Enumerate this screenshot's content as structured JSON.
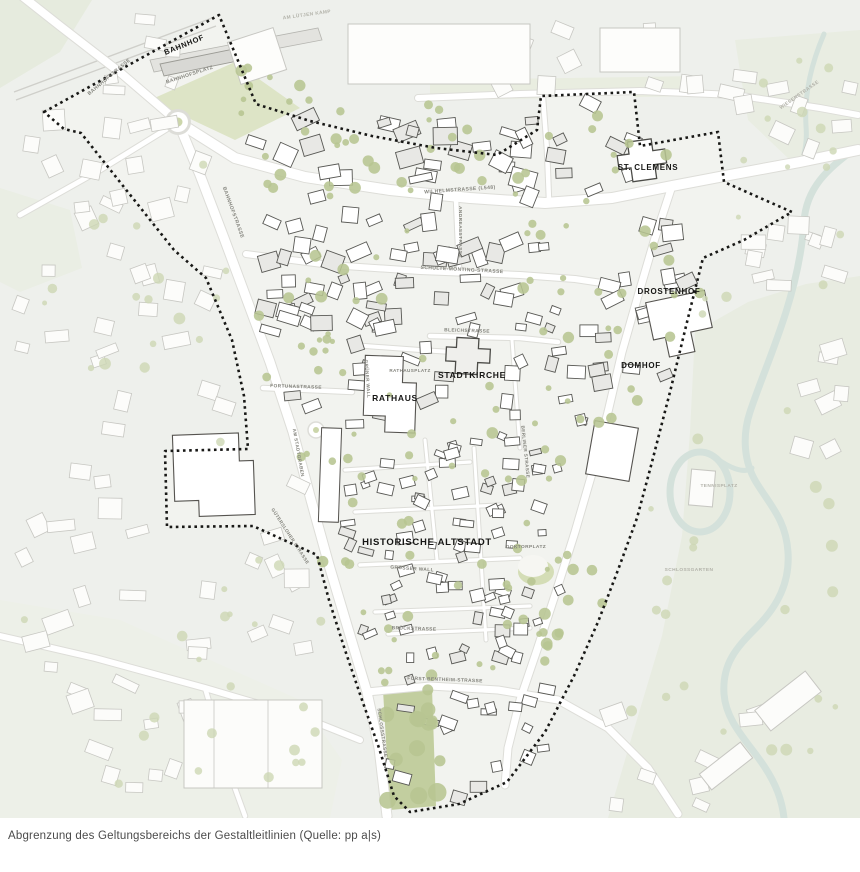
{
  "figure": {
    "type": "city-map",
    "subject": "Abgrenzung Geltungsbereich Gestaltleitlinien"
  },
  "caption": {
    "text": "Abgrenzung des Geltungsbereichs der Gestaltleitlinien (Quelle: pp a|s)"
  },
  "map": {
    "landmarks": [
      {
        "id": "bahnhof",
        "label": "BAHNHOF"
      },
      {
        "id": "st-clemens",
        "label": "ST. CLEMENS"
      },
      {
        "id": "drostenhof",
        "label": "DROSTENHOF"
      },
      {
        "id": "domhof",
        "label": "DOMHOF"
      },
      {
        "id": "stadtkirche",
        "label": "STADTKIRCHE"
      },
      {
        "id": "rathaus",
        "label": "RATHAUS"
      },
      {
        "id": "historische-altstadt",
        "label": "HISTORISCHE ALTSTADT"
      }
    ],
    "streets": [
      {
        "id": "bahnhofsplatz",
        "label": "BAHNHOFSPLATZ"
      },
      {
        "id": "bahnhofstrasse-nw",
        "label": "BAHNHOFSTRASSE"
      },
      {
        "id": "bahnhofstrasse-s",
        "label": "BAHNHOFSTRASSE"
      },
      {
        "id": "am-luetjen-kamp",
        "label": "AM LÜTJEN KAMP"
      },
      {
        "id": "wilhelmstrasse",
        "label": "WILHELMSTRASSE (L548)"
      },
      {
        "id": "andreasstrasse",
        "label": "ANDREASSTRASSE"
      },
      {
        "id": "schulte-moenting",
        "label": "SCHULTE-MÖNTING-STRASSE"
      },
      {
        "id": "bleichstrasse",
        "label": "BLEICHSTRASSE"
      },
      {
        "id": "rathausplatz",
        "label": "RATHAUSPLATZ"
      },
      {
        "id": "fortunastrasse",
        "label": "FORTUNASTRASSE"
      },
      {
        "id": "gruener-wall",
        "label": "GRÜNER WALL"
      },
      {
        "id": "am-stadtgraben",
        "label": "AM STADTGRABEN"
      },
      {
        "id": "guetersloher-strasse",
        "label": "GÜTERSLOHER STRASSE"
      },
      {
        "id": "grosser-wall",
        "label": "GROSSER WALL"
      },
      {
        "id": "doktorplatz",
        "label": "DOKTORPLATZ"
      },
      {
        "id": "berliner-strasse",
        "label": "BERLINER STRASSE"
      },
      {
        "id": "brueckstrasse",
        "label": "BRÜCKSTRASSE"
      },
      {
        "id": "fuerst-bentheim",
        "label": "FÜRST-BENTHEIM-STRASSE"
      },
      {
        "id": "schlossstrasse",
        "label": "SCHLOSSSTRASSE"
      },
      {
        "id": "wiesenstrasse",
        "label": "WIESENSTRASSE"
      },
      {
        "id": "tennisplatz",
        "label": "TENNISPLATZ"
      },
      {
        "id": "schlossgarten",
        "label": "SCHLOSSGARTEN"
      }
    ],
    "colors": {
      "background": "#eef0ec",
      "inside_area": "#f2f3ef",
      "boundary": "#181816",
      "road": "#ffffff",
      "green": "#b7c592",
      "pale_green": "#e8ece1",
      "water": "#d4e1db",
      "building_stroke_inside": "#585854",
      "building_stroke_outside": "#c7c7c2",
      "landmark_label": "#161614",
      "street_label": "#83837c",
      "caption_text": "#4b4b4b"
    }
  }
}
